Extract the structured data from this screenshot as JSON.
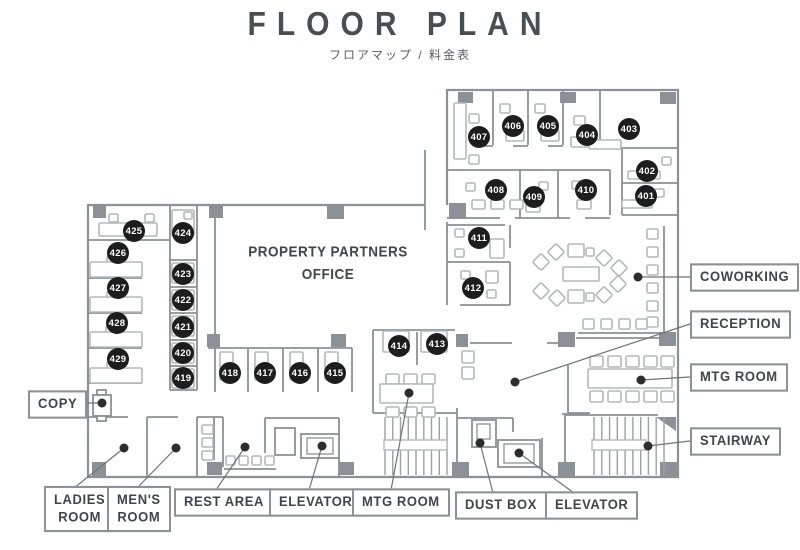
{
  "header": {
    "title": "FLOOR PLAN",
    "subtitle": "フロアマップ / 料金表"
  },
  "plan": {
    "office_label": "PROPERTY PARTNERS\nOFFICE",
    "rooms": [
      "401",
      "402",
      "403",
      "404",
      "405",
      "406",
      "407",
      "408",
      "409",
      "410",
      "411",
      "412",
      "413",
      "414",
      "415",
      "416",
      "417",
      "418",
      "419",
      "420",
      "421",
      "422",
      "423",
      "424",
      "425",
      "426",
      "427",
      "428",
      "429"
    ]
  },
  "callouts": {
    "coworking": "COWORKING",
    "reception": "RECEPTION",
    "mtg_room_right": "MTG ROOM",
    "stairway": "STAIRWAY",
    "copy": "COPY",
    "ladies_room": "LADIES\nROOM",
    "mens_room": "MEN'S\nROOM",
    "rest_area": "REST AREA",
    "elevator_bottom_left": "ELEVATOR",
    "mtg_room_bottom": "MTG ROOM",
    "dust_box": "DUST BOX",
    "elevator_bottom_right": "ELEVATOR"
  },
  "colors": {
    "wall": "#8b9196",
    "furniture": "#b2b8bc",
    "badge": "#1d1d1d",
    "label_text": "#3e454c",
    "callout_line": "#6d7378"
  }
}
